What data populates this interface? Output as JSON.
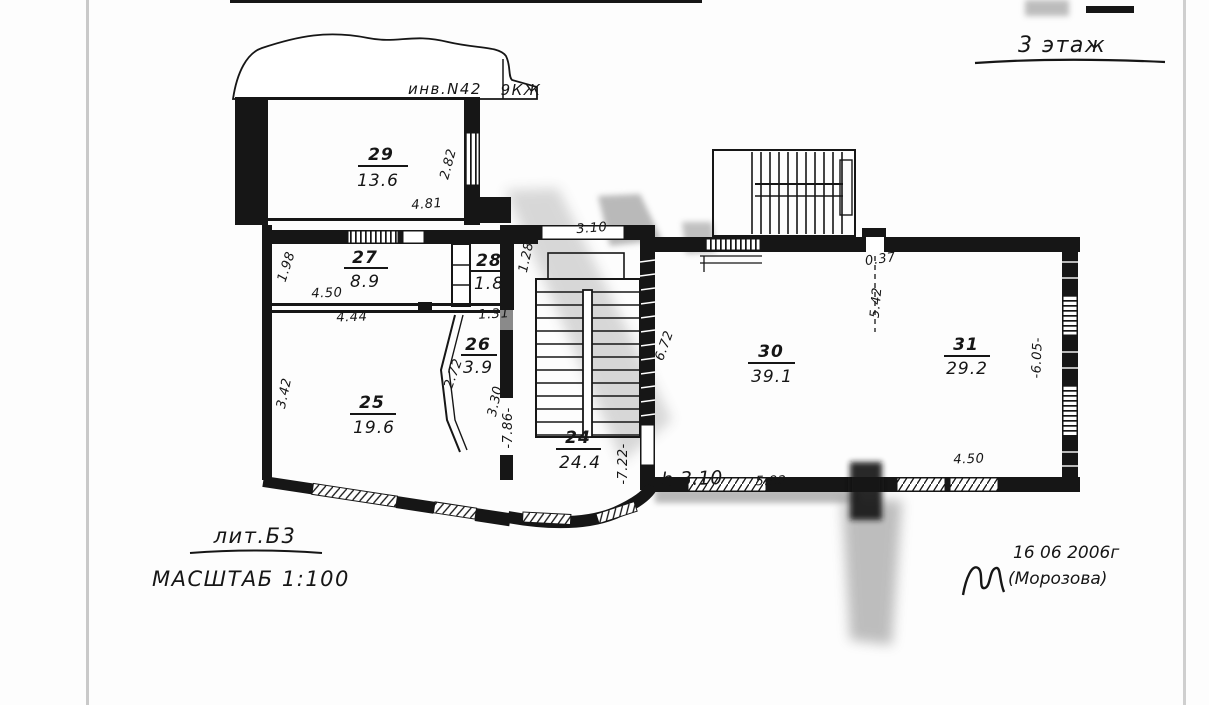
{
  "annotations": {
    "floor": "3 этаж",
    "inventory": "инв.N42",
    "series": "9КЖ",
    "liter": "лит.Б3",
    "scale": "МАСШТАБ  1:100",
    "date": "16  06 2006г",
    "executor": "(Морозова)",
    "ceiling_height": "h-3.10"
  },
  "rooms": [
    {
      "number": "29",
      "area": "13.6"
    },
    {
      "number": "27",
      "area": "8.9"
    },
    {
      "number": "28",
      "area": "1.8"
    },
    {
      "number": "26",
      "area": "3.9"
    },
    {
      "number": "25",
      "area": "19.6"
    },
    {
      "number": "24",
      "area": "24.4"
    },
    {
      "number": "30",
      "area": "39.1"
    },
    {
      "number": "31",
      "area": "29.2"
    }
  ],
  "dimensions": {
    "room29_side": "2.82",
    "room29_width": "4.81",
    "room27_left": "1.98",
    "room27_width": "4.50",
    "hall_width": "4.44",
    "hall_right": "1.31",
    "stair_left": "1.28",
    "stair_width": "3.10",
    "room26_slant": "2.72",
    "room26_right": "3.30",
    "room25_left": "3.42",
    "room24_left": "-7.86-",
    "room24_right": "-7.22-",
    "stair_side": "6.72",
    "door_offset": "0.37",
    "room30_side": "5.42",
    "room31_right": "-6.05-",
    "room31_bottom": "4.50",
    "room30_bottom": "5.82"
  }
}
